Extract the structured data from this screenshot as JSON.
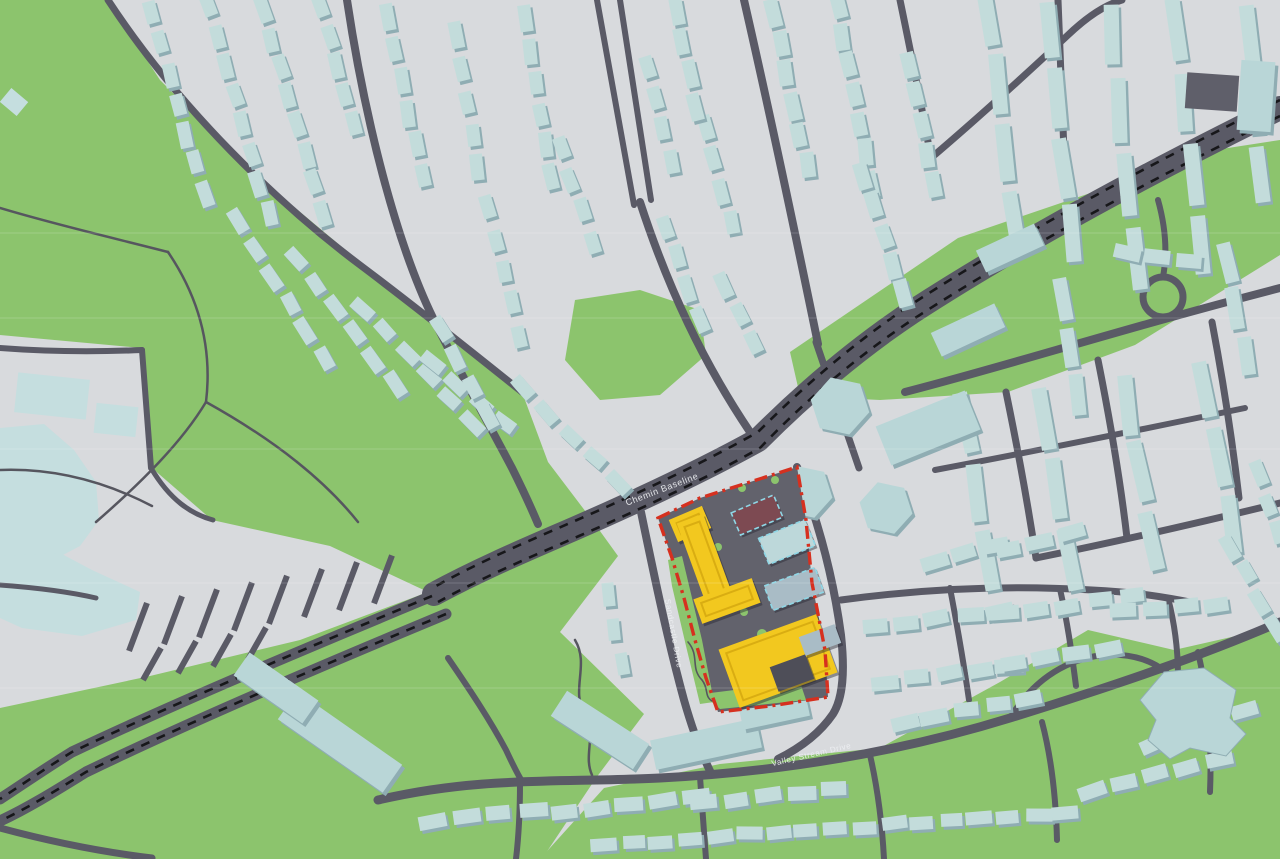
{
  "title": "3D development site map",
  "labels": {
    "baseline": "Chemin Baseline",
    "sandcastle": "Sandcastle Drive",
    "valley_stream": "Valley Stream Drive"
  },
  "colors": {
    "base": "#d8dadd",
    "park": "#8cc46d",
    "road": "#5a5a66",
    "trail": "#56565f",
    "transit_dash": "#17171a",
    "house": "#c3dcdb",
    "house_shadow": "#8fadb3",
    "slab": "#b9d6d7",
    "campus": "#c5dedf",
    "dark_building": "#5f5f6a",
    "site_ground": "#62626c",
    "site_courtyard": "#4e4e58",
    "proposal_yellow": "#f2c81f",
    "proposal_roof": "#d9ad12",
    "proposal_maroon": "#7d4a52",
    "site_blue": "#bdd8da",
    "site_gray_blue": "#a9bcc6",
    "selection_dash": "#8fd7e6",
    "boundary_red": "#d6301f",
    "label_text": "#eef0f3",
    "seam": "rgba(255,255,255,0.18)"
  },
  "map": {
    "parks": [
      "0,0 108,0 160,80 250,170 360,262 480,360 522,392 548,462 592,520 618,556 560,632 644,714 596,778 542,859 0,859",
      "575,300 640,290 700,310 706,355 660,395 600,400 565,360",
      "1280,140 1280,255 1135,345 1008,392 880,400 800,396 790,352 958,238 1105,188 1215,150",
      "540,859 604,788 720,764 880,748 1000,682 1088,630 1174,650 1280,626 1280,859"
    ],
    "campus_overlay": "0,335 142,348 152,468 212,520 330,546 428,592 300,640 150,676 0,708",
    "campus_blobs": [
      "0,428 44,424 74,450 96,482 99,520 80,546 42,566 8,568 0,562",
      "0,556 60,553 92,570 140,592 136,620 82,636 22,628 0,618"
    ],
    "campus_rects": [
      {
        "x": 52,
        "y": 396,
        "w": 72,
        "h": 40,
        "r": 6
      },
      {
        "x": 116,
        "y": 420,
        "w": 42,
        "h": 30,
        "r": 6
      },
      {
        "x": 14,
        "y": 102,
        "w": 22,
        "h": 18,
        "r": 40
      }
    ],
    "roads": [
      {
        "d": "M108,0 C180,110 280,205 360,265 C420,310 472,352 522,392",
        "w": 7
      },
      {
        "d": "M347,0 C365,120 396,242 433,318 C456,365 492,430 512,468 C522,488 530,505 538,524",
        "w": 8
      },
      {
        "d": "M597,0 L634,205",
        "w": 6
      },
      {
        "d": "M620,0 L651,200",
        "w": 6
      },
      {
        "d": "M640,202 C668,288 703,362 750,432",
        "w": 8
      },
      {
        "d": "M744,0 C771,118 795,232 818,344",
        "w": 8
      },
      {
        "d": "M900,0 C912,58 922,108 931,158",
        "w": 7
      },
      {
        "d": "M1058,0 L1064,152",
        "w": 7
      },
      {
        "d": "M931,158 C978,118 1022,78 1068,35 C1090,14 1108,4 1122,0",
        "w": 7
      },
      {
        "d": "M816,342 C832,390 846,430 859,468",
        "w": 7
      },
      {
        "d": "M905,392 C1010,365 1125,328 1280,288",
        "w": 8
      },
      {
        "d": "M1006,392 C1018,450 1028,505 1036,558",
        "w": 7
      },
      {
        "d": "M1098,360 C1110,420 1120,478 1127,538",
        "w": 7
      },
      {
        "d": "M1212,322 C1223,380 1232,438 1239,498",
        "w": 7
      },
      {
        "d": "M1036,558 C1110,543 1190,525 1280,503",
        "w": 7
      },
      {
        "d": "M935,470 C1030,452 1130,432 1245,408",
        "w": 6
      },
      {
        "d": "M1143,297 a20,20 0 1,0 40,0 a20,20 0 1,0 -40,0",
        "w": 7
      },
      {
        "d": "M1163,277 C1168,250 1165,225 1158,200",
        "w": 6
      },
      {
        "d": "M378,800 C480,776 560,783 660,778 C780,772 900,752 1010,718 C1100,690 1192,660 1280,622",
        "w": 9
      },
      {
        "d": "M641,512 C653,570 667,638 684,700 C692,728 701,753 711,773",
        "w": 8
      },
      {
        "d": "M797,467 C818,520 833,575 841,635 C845,672 843,698 833,714 C820,733 800,748 778,759",
        "w": 8
      },
      {
        "d": "M841,600 C930,588 1012,585 1092,590 C1135,592 1165,597 1195,603",
        "w": 7
      },
      {
        "d": "M950,588 C958,630 964,665 969,700",
        "w": 6
      },
      {
        "d": "M1060,589 C1068,625 1072,655 1076,686",
        "w": 6
      },
      {
        "d": "M1168,598 C1175,625 1178,650 1178,676",
        "w": 6
      },
      {
        "d": "M1010,718 C1032,682 1062,662 1096,656 C1130,651 1158,661 1174,680",
        "w": 6
      },
      {
        "d": "M448,658 C470,690 490,720 506,750 C513,765 518,775 523,783",
        "w": 6
      },
      {
        "d": "M520,783 C520,818 518,842 516,859",
        "w": 6
      },
      {
        "d": "M700,777 L706,859",
        "w": 6
      },
      {
        "d": "M870,755 C878,790 882,822 884,859",
        "w": 6
      },
      {
        "d": "M1042,722 C1052,760 1056,800 1057,840",
        "w": 6
      },
      {
        "d": "M1198,652 C1209,700 1212,745 1210,792",
        "w": 6
      },
      {
        "d": "M0,348 C52,352 96,352 142,350",
        "w": 6
      },
      {
        "d": "M142,350 L151,468",
        "w": 6
      },
      {
        "d": "M151,468 C170,500 191,514 213,520",
        "w": 5
      },
      {
        "d": "M0,585 C40,588 70,592 96,598",
        "w": 5
      },
      {
        "d": "M0,828 C52,842 102,852 152,858",
        "w": 7
      }
    ],
    "arterial": {
      "d": "M1280,108 C1150,172 1020,242 912,312 C852,352 802,396 758,440 C700,472 640,500 576,528 C530,548 482,568 434,594",
      "w": 24
    },
    "highway": [
      {
        "d": "M432,596 C312,646 182,700 72,752 C46,768 20,786 0,799",
        "w": 11
      },
      {
        "d": "M446,614 C326,664 196,719 86,772 C60,788 30,807 0,821",
        "w": 11
      }
    ],
    "transit": [
      "M1280,100 C1150,164 1020,234 912,304 C852,344 802,388 758,432 C701,464 641,492 577,520 C531,540 483,560 436,586",
      "M1280,116 C1150,180 1020,250 912,320 C852,360 802,404 760,448 C703,480 643,508 579,536 C533,556 485,576 438,602",
      "M432,596 C312,646 182,700 72,752 C46,768 20,786 0,799",
      "M446,614 C326,664 196,719 86,772 C60,788 30,807 0,821"
    ],
    "trails": [
      "M0,208 C60,226 122,240 168,252",
      "M168,252 C202,302 212,352 206,402",
      "M206,402 C182,442 142,482 96,522",
      "M206,402 C242,422 272,442 297,462",
      "M0,470 C52,468 102,480 152,506",
      "M297,462 C322,482 342,502 358,522",
      "M575,640 C590,665 570,690 585,715 C597,735 583,755 592,775"
    ],
    "parking_rows": [
      {
        "n": 8,
        "x0": 138,
        "y0": 627,
        "dx": 35,
        "dy": -6.8,
        "len": 24
      },
      {
        "n": 4,
        "x0": 152,
        "y0": 664,
        "dx": 35,
        "dy": -6.8,
        "len": 16
      }
    ],
    "house_blocks": [
      {
        "x": 152,
        "y": 14,
        "a": 74,
        "n": 7,
        "w": 24,
        "h": 13,
        "g": 7
      },
      {
        "x": 208,
        "y": 6,
        "a": 74,
        "n": 8,
        "w": 24,
        "h": 13,
        "g": 7
      },
      {
        "x": 264,
        "y": 10,
        "a": 74,
        "n": 8,
        "w": 24,
        "h": 13,
        "g": 6
      },
      {
        "x": 320,
        "y": 6,
        "a": 74,
        "n": 5,
        "w": 24,
        "h": 13,
        "g": 7
      },
      {
        "x": 238,
        "y": 222,
        "a": 58,
        "n": 6,
        "w": 24,
        "h": 13,
        "g": 8
      },
      {
        "x": 296,
        "y": 258,
        "a": 52,
        "n": 6,
        "w": 24,
        "h": 13,
        "g": 8
      },
      {
        "x": 362,
        "y": 308,
        "a": 46,
        "n": 6,
        "w": 24,
        "h": 13,
        "g": 8
      },
      {
        "x": 432,
        "y": 362,
        "a": 40,
        "n": 4,
        "w": 24,
        "h": 13,
        "g": 8
      },
      {
        "x": 388,
        "y": 16,
        "a": 78,
        "n": 6,
        "w": 25,
        "h": 13,
        "g": 8
      },
      {
        "x": 455,
        "y": 36,
        "a": 80,
        "n": 5,
        "w": 24,
        "h": 13,
        "g": 9
      },
      {
        "x": 524,
        "y": 20,
        "a": 80,
        "n": 6,
        "w": 24,
        "h": 13,
        "g": 8
      },
      {
        "x": 560,
        "y": 148,
        "a": 70,
        "n": 4,
        "w": 24,
        "h": 13,
        "g": 9
      },
      {
        "x": 486,
        "y": 208,
        "a": 75,
        "n": 5,
        "w": 24,
        "h": 13,
        "g": 9
      },
      {
        "x": 440,
        "y": 330,
        "a": 60,
        "n": 4,
        "w": 24,
        "h": 13,
        "g": 9
      },
      {
        "x": 524,
        "y": 388,
        "a": 45,
        "n": 5,
        "w": 24,
        "h": 13,
        "g": 9
      },
      {
        "x": 648,
        "y": 66,
        "a": 76,
        "n": 4,
        "w": 24,
        "h": 13,
        "g": 9
      },
      {
        "x": 706,
        "y": 126,
        "a": 76,
        "n": 4,
        "w": 24,
        "h": 13,
        "g": 9
      },
      {
        "x": 666,
        "y": 226,
        "a": 70,
        "n": 4,
        "w": 24,
        "h": 13,
        "g": 9
      },
      {
        "x": 724,
        "y": 286,
        "a": 62,
        "n": 3,
        "w": 24,
        "h": 13,
        "g": 9
      },
      {
        "x": 676,
        "y": 12,
        "a": 78,
        "n": 4,
        "w": 25,
        "h": 13,
        "g": 7
      },
      {
        "x": 774,
        "y": 14,
        "a": 78,
        "n": 6,
        "w": 26,
        "h": 14,
        "g": 5
      },
      {
        "x": 838,
        "y": 6,
        "a": 80,
        "n": 7,
        "w": 26,
        "h": 14,
        "g": 4
      },
      {
        "x": 864,
        "y": 176,
        "a": 72,
        "n": 5,
        "w": 26,
        "h": 14,
        "g": 5
      },
      {
        "x": 908,
        "y": 64,
        "a": 78,
        "n": 5,
        "w": 26,
        "h": 14,
        "g": 5
      },
      {
        "x": 988,
        "y": 18,
        "a": 83,
        "n": 4,
        "w": 58,
        "h": 15,
        "g": 10
      },
      {
        "x": 1048,
        "y": 32,
        "a": 83,
        "n": 4,
        "w": 58,
        "h": 15,
        "g": 10
      },
      {
        "x": 1112,
        "y": 36,
        "a": 84,
        "n": 4,
        "w": 62,
        "h": 15,
        "g": 12
      },
      {
        "x": 1178,
        "y": 30,
        "a": 84,
        "n": 4,
        "w": 60,
        "h": 15,
        "g": 12
      },
      {
        "x": 1248,
        "y": 34,
        "a": 85,
        "n": 3,
        "w": 58,
        "h": 15,
        "g": 12
      },
      {
        "x": 964,
        "y": 424,
        "a": 80,
        "n": 3,
        "w": 60,
        "h": 15,
        "g": 10
      },
      {
        "x": 1044,
        "y": 418,
        "a": 80,
        "n": 3,
        "w": 62,
        "h": 15,
        "g": 10
      },
      {
        "x": 1128,
        "y": 404,
        "a": 80,
        "n": 3,
        "w": 60,
        "h": 15,
        "g": 10
      },
      {
        "x": 1206,
        "y": 390,
        "a": 80,
        "n": 3,
        "w": 58,
        "h": 15,
        "g": 10
      },
      {
        "x": 1126,
        "y": 252,
        "a": 8,
        "n": 3,
        "w": 26,
        "h": 14,
        "g": 6
      },
      {
        "x": 1062,
        "y": 300,
        "a": 80,
        "n": 3,
        "w": 40,
        "h": 14,
        "g": 8
      },
      {
        "x": 1226,
        "y": 262,
        "a": 78,
        "n": 3,
        "w": 40,
        "h": 14,
        "g": 8
      },
      {
        "x": 874,
        "y": 628,
        "a": -8,
        "n": 5,
        "w": 26,
        "h": 14,
        "g": 6
      },
      {
        "x": 1004,
        "y": 614,
        "a": -8,
        "n": 5,
        "w": 26,
        "h": 14,
        "g": 6
      },
      {
        "x": 1122,
        "y": 612,
        "a": -5,
        "n": 4,
        "w": 26,
        "h": 14,
        "g": 6
      },
      {
        "x": 884,
        "y": 682,
        "a": -8,
        "n": 5,
        "w": 26,
        "h": 14,
        "g": 6
      },
      {
        "x": 1014,
        "y": 662,
        "a": -8,
        "n": 4,
        "w": 26,
        "h": 14,
        "g": 6
      },
      {
        "x": 904,
        "y": 722,
        "a": -10,
        "n": 5,
        "w": 26,
        "h": 14,
        "g": 6
      },
      {
        "x": 1232,
        "y": 546,
        "a": 62,
        "n": 4,
        "w": 24,
        "h": 13,
        "g": 7
      },
      {
        "x": 1258,
        "y": 474,
        "a": 72,
        "n": 3,
        "w": 24,
        "h": 13,
        "g": 7
      },
      {
        "x": 434,
        "y": 822,
        "a": -8,
        "n": 4,
        "w": 26,
        "h": 14,
        "g": 7
      },
      {
        "x": 564,
        "y": 812,
        "a": -6,
        "n": 5,
        "w": 26,
        "h": 14,
        "g": 7
      },
      {
        "x": 704,
        "y": 802,
        "a": -6,
        "n": 5,
        "w": 26,
        "h": 14,
        "g": 7
      },
      {
        "x": 604,
        "y": 845,
        "a": -4,
        "n": 17,
        "w": 24,
        "h": 13,
        "g": 5
      },
      {
        "x": 1094,
        "y": 792,
        "a": -15,
        "n": 5,
        "w": 26,
        "h": 14,
        "g": 6
      },
      {
        "x": 1154,
        "y": 744,
        "a": -20,
        "n": 4,
        "w": 26,
        "h": 14,
        "g": 6
      },
      {
        "x": 608,
        "y": 594,
        "a": 80,
        "n": 3,
        "w": 22,
        "h": 12,
        "g": 14
      },
      {
        "x": 934,
        "y": 560,
        "a": -14,
        "n": 3,
        "w": 26,
        "h": 14,
        "g": 6
      },
      {
        "x": 1008,
        "y": 548,
        "a": -14,
        "n": 3,
        "w": 26,
        "h": 14,
        "g": 6
      }
    ],
    "slabs": [
      {
        "x": 340,
        "y": 742,
        "a": 35,
        "w": 128,
        "h": 34
      },
      {
        "x": 600,
        "y": 730,
        "a": 33,
        "w": 98,
        "h": 30
      },
      {
        "x": 706,
        "y": 744,
        "a": -12,
        "w": 108,
        "h": 30
      },
      {
        "x": 774,
        "y": 710,
        "a": -12,
        "w": 68,
        "h": 26
      },
      {
        "x": 276,
        "y": 688,
        "a": 35,
        "w": 84,
        "h": 28
      },
      {
        "x": 928,
        "y": 428,
        "a": -22,
        "w": 96,
        "h": 42
      },
      {
        "x": 1256,
        "y": 96,
        "a": 4,
        "w": 34,
        "h": 70
      },
      {
        "x": 968,
        "y": 330,
        "a": -25,
        "w": 70,
        "h": 26
      },
      {
        "x": 1010,
        "y": 248,
        "a": -25,
        "w": 64,
        "h": 24
      }
    ],
    "hexes": [
      {
        "cx": 840,
        "cy": 406,
        "r": 30
      },
      {
        "cx": 806,
        "cy": 492,
        "r": 27
      },
      {
        "cx": 886,
        "cy": 508,
        "r": 27
      }
    ],
    "dark_building": {
      "x": 1212,
      "y": 92,
      "w": 52,
      "h": 36,
      "r": 4
    },
    "school": "1140,700 1164,672 1204,668 1236,690 1230,718 1246,734 1226,756 1190,748 1170,759 1148,740 1156,720",
    "seams": [
      233,
      318,
      449,
      583,
      688
    ],
    "site": {
      "ground": "658,518 700,498 797,467 806,520 812,583 825,650 828,697 770,706 718,712 706,678 695,640 684,598 672,558",
      "green_patches": [
        "668,560 682,556 702,640 714,702 700,704 686,646 672,586",
        "702,694 800,682 806,700 720,709"
      ],
      "green_dots": [
        {
          "cx": 700,
          "cy": 530,
          "r": 5
        },
        {
          "cx": 718,
          "cy": 547,
          "r": 4
        },
        {
          "cx": 762,
          "cy": 634,
          "r": 5
        },
        {
          "cx": 744,
          "cy": 612,
          "r": 4
        },
        {
          "cx": 705,
          "cy": 612,
          "r": 4
        },
        {
          "cx": 775,
          "cy": 480,
          "r": 4
        },
        {
          "cx": 742,
          "cy": 488,
          "r": 4
        }
      ],
      "wiggle_path": "M688,642 C700,656 690,668 702,680 C709,689 704,696 712,701",
      "buildings": [
        {
          "name": "proposal-yellow-wing",
          "x": 690,
          "y": 524,
          "w": 36,
          "h": 24,
          "r": -23,
          "fill": "yellow"
        },
        {
          "name": "proposal-yellow-tower",
          "x": 705,
          "y": 560,
          "w": 28,
          "h": 88,
          "r": -20,
          "fill": "yellow"
        },
        {
          "name": "proposal-yellow-bar",
          "x": 727,
          "y": 601,
          "w": 62,
          "h": 26,
          "r": -20,
          "fill": "yellow"
        },
        {
          "name": "proposal-yellow-block",
          "x": 778,
          "y": 661,
          "w": 104,
          "h": 62,
          "r": -20,
          "fill": "yellow"
        },
        {
          "name": "courtyard",
          "x": 792,
          "y": 673,
          "w": 38,
          "h": 26,
          "r": -20,
          "fill": "courtyard"
        },
        {
          "name": "proposal-maroon-building",
          "x": 757,
          "y": 515,
          "w": 46,
          "h": 24,
          "r": -23,
          "fill": "maroon",
          "sel": true
        },
        {
          "name": "site-blue-building",
          "x": 787,
          "y": 542,
          "w": 50,
          "h": 28,
          "r": -22,
          "fill": "blue",
          "sel": true
        },
        {
          "name": "site-grayblue-building",
          "x": 794,
          "y": 589,
          "w": 54,
          "h": 26,
          "r": -20,
          "fill": "grayblue",
          "sel": true
        },
        {
          "name": "site-small-building",
          "x": 820,
          "y": 640,
          "w": 38,
          "h": 20,
          "r": -20,
          "fill": "grayblue"
        }
      ],
      "boundary": "658,518 700,498 797,467 806,520 812,583 825,650 828,697 770,706 718,712 706,678 695,640 684,598 672,558"
    }
  }
}
